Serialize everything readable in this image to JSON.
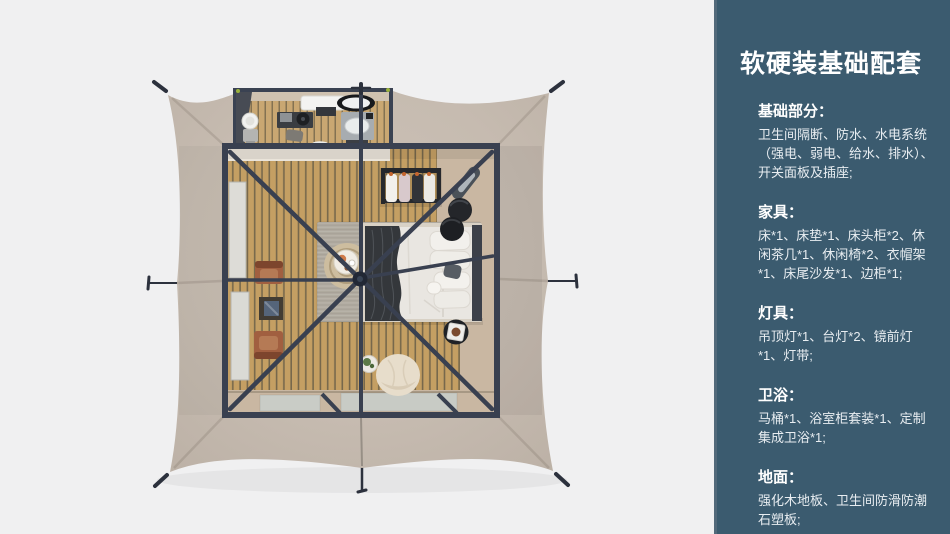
{
  "page": {
    "background_color": "#f0f0f1"
  },
  "floorplan": {
    "description_colors": {
      "tent_canvas": "#c6bbb0",
      "frame_poles": "#394050",
      "wood_floor": "#c49f63",
      "area_rug": "#b1aba0",
      "bed_duvet": "#e8e5e0",
      "bed_throw": "#35383c",
      "leather_chair": "#a15f40",
      "bean_bag": "#e7ddcb",
      "bathroom_unit": "#a7acb0"
    }
  },
  "sidebar": {
    "background_color": "#3b5b6f",
    "text_color": "#e8edf1",
    "title": "软硬装基础配套",
    "sections": [
      {
        "heading": "基础部分：",
        "body": "卫生间隔断、防水、水电系统（强电、弱电、给水、排水）、开关面板及插座;"
      },
      {
        "heading": "家具：",
        "body": "床*1、床垫*1、床头柜*2、休闲茶几*1、休闲椅*2、衣帽架*1、床尾沙发*1、边柜*1;"
      },
      {
        "heading": "灯具：",
        "body": "吊顶灯*1、台灯*2、镜前灯*1、灯带;"
      },
      {
        "heading": "卫浴：",
        "body": "马桶*1、浴室柜套装*1、定制集成卫浴*1;"
      },
      {
        "heading": "地面：",
        "body": "强化木地板、卫生间防滑防潮石塑板;"
      }
    ]
  }
}
